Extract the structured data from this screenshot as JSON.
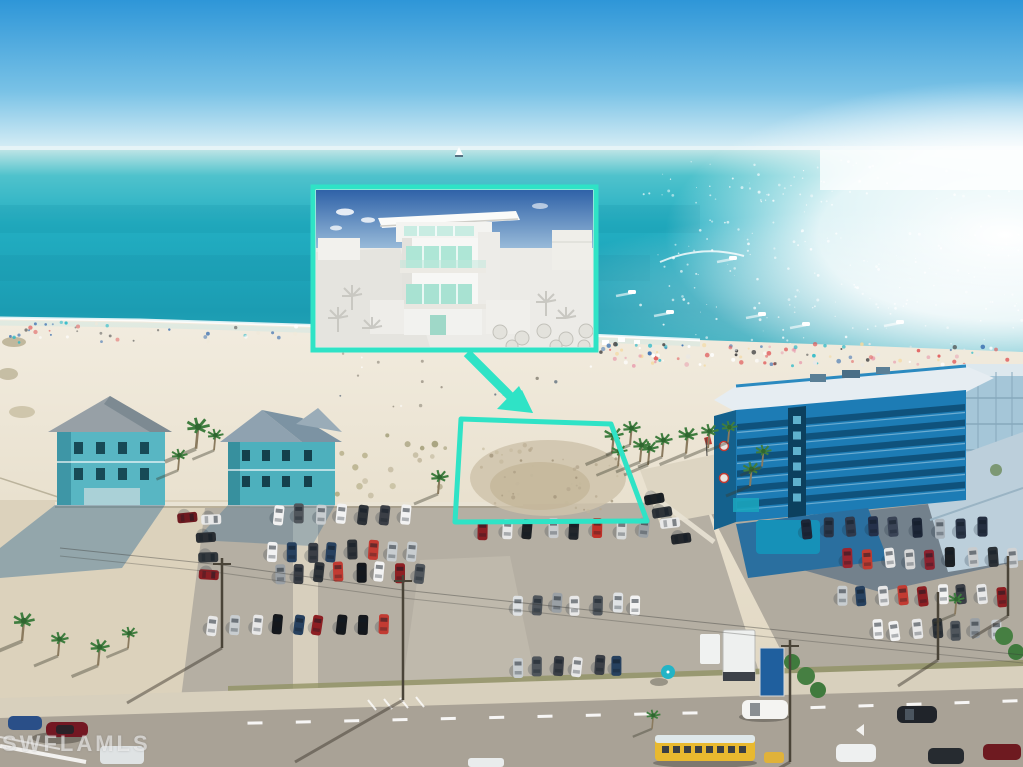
{
  "watermark": {
    "text": "SWFLAMLS"
  },
  "palette": {
    "accent_teal": "#2FE3C6",
    "sky_top": "#2E96D8",
    "sky_horizon": "#DCF0F6",
    "ocean_turquoise": "#27B4C6",
    "ocean_deep": "#1B9CB2",
    "sand_light": "#EFE9DB",
    "asphalt": "#B5AFA3",
    "road": "#A9A296",
    "hotel_blue": "#1D7CB5",
    "house_teal": "#55B6C2",
    "bus_yellow": "#E8B92F",
    "car_default": [
      "#f2f2f2",
      "#dfe2e4",
      "#15181c",
      "#2e3338",
      "#9aa0a5",
      "#8e1f23",
      "#c23b32",
      "#27415f",
      "#c8cdd0",
      "#3b3f46",
      "#e8e8e8",
      "#50565c"
    ]
  },
  "scene": {
    "boats": [
      {
        "x": 632,
        "y": 292
      },
      {
        "x": 670,
        "y": 312
      },
      {
        "x": 762,
        "y": 314
      },
      {
        "x": 806,
        "y": 324
      },
      {
        "x": 900,
        "y": 322
      },
      {
        "x": 733,
        "y": 258
      }
    ],
    "sailboat": {
      "x": 459,
      "y": 152
    },
    "hotel_floors": {
      "x0": 737,
      "y0l": 424,
      "x1": 965,
      "y0r": 404,
      "n": 6,
      "step": 15.5,
      "h": 6.5
    },
    "tower_windows": {
      "x": 793,
      "y0": 416,
      "n": 6,
      "step": 15.5,
      "w": 8,
      "h": 8
    },
    "dot_bands": [
      {
        "seed": 11,
        "x0": 598,
        "x1": 1020,
        "y0": 344,
        "y1": 366,
        "n": 115,
        "rmin": 1,
        "rmax": 2.4,
        "palette": [
          "#ffffff",
          "#e8e8e8",
          "#e05a5a",
          "#3a6fb0",
          "#28b8c8",
          "#e8a0b0",
          "#444444",
          "#f4d9a0"
        ],
        "op": 0.95
      },
      {
        "seed": 12,
        "x0": 10,
        "x1": 310,
        "y0": 322,
        "y1": 344,
        "n": 42,
        "rmin": 0.9,
        "rmax": 2.2,
        "palette": [
          "#ffffff",
          "#e05a5a",
          "#3a6fb0",
          "#28b8c8",
          "#555555",
          "#f0e8d8"
        ],
        "op": 0.9
      },
      {
        "seed": 13,
        "x0": 320,
        "x1": 600,
        "y0": 340,
        "y1": 412,
        "n": 26,
        "rmin": 0.8,
        "rmax": 1.8,
        "palette": [
          "#8a8274",
          "#6f685c",
          "#ffffff",
          "#5a6a7a"
        ],
        "op": 0.8
      },
      {
        "seed": 14,
        "x0": 940,
        "x1": 1020,
        "y0": 368,
        "y1": 395,
        "n": 18,
        "rmin": 1,
        "rmax": 2.2,
        "palette": [
          "#28b8c8",
          "#3a6fb0",
          "#ffffff",
          "#e05a5a"
        ],
        "op": 0.9
      },
      {
        "seed": 15,
        "x0": 480,
        "x1": 625,
        "y0": 445,
        "y1": 512,
        "n": 46,
        "rmin": 0.8,
        "rmax": 2.2,
        "palette": [
          "#b6a88e",
          "#a2947a",
          "#c4b89c"
        ],
        "op": 0.85
      },
      {
        "seed": 16,
        "x0": 335,
        "x1": 450,
        "y0": 435,
        "y1": 498,
        "n": 18,
        "rmin": 1.5,
        "rmax": 3.5,
        "palette": [
          "#a8a176",
          "#8f8a60",
          "#b5ab8d"
        ],
        "op": 0.8
      }
    ],
    "sparkles": {
      "seed": 21,
      "x0": 640,
      "x1": 1022,
      "y0": 158,
      "y1": 345,
      "n": 230,
      "rmin": 0.4,
      "rmax": 1.5,
      "palette": [
        "#ffffff"
      ],
      "op": 0.8
    },
    "car_rows": [
      {
        "seed": 31,
        "x0": 278,
        "y": 514,
        "dx": 21,
        "n": 7,
        "angle": 4
      },
      {
        "seed": 32,
        "x0": 483,
        "y": 529,
        "dx": 23,
        "n": 8,
        "angle": 3,
        "colors": [
          "#8a1f24",
          "#e8e8e8",
          "#1c2024",
          "#c9ccce",
          "#23272c",
          "#c03028",
          "#d8dad9",
          "#9aa0a4"
        ]
      },
      {
        "seed": 33,
        "x0": 272,
        "y": 551,
        "dx": 20,
        "n": 8,
        "angle": 2
      },
      {
        "seed": 34,
        "x0": 280,
        "y": 573,
        "dx": 20,
        "n": 8,
        "angle": 2
      },
      {
        "seed": 35,
        "x0": 214,
        "y": 626,
        "dx": 21,
        "n": 9,
        "angle": 5
      },
      {
        "seed": 36,
        "x0": 516,
        "y": 604,
        "dx": 20,
        "n": 7,
        "angle": 3
      },
      {
        "seed": 37,
        "x0": 518,
        "y": 666,
        "dx": 20,
        "n": 6,
        "angle": 3
      },
      {
        "seed": 38,
        "x0": 205,
        "y": 536,
        "dx": 2,
        "dy": 20,
        "n": 3,
        "angle": 90,
        "colors": [
          "#2a2e33",
          "#33383d",
          "#8a1f24"
        ]
      },
      {
        "seed": 39,
        "x0": 656,
        "y": 498,
        "dx": 8,
        "dy": 13,
        "n": 4,
        "angle": 80,
        "colors": [
          "#1c2024",
          "#2e3338",
          "#e8e8e8",
          "#23272c"
        ]
      },
      {
        "seed": 40,
        "x0": 806,
        "y": 528,
        "dx": 22,
        "n": 9,
        "angle": -2,
        "colors": [
          "#1d2738",
          "#2a3547",
          "#303a4c",
          "#24304a",
          "#3a4456",
          "#1d2738",
          "#aab4bc",
          "#2a3547",
          "#242e40"
        ]
      },
      {
        "seed": 41,
        "x0": 846,
        "y": 558,
        "dx": 21,
        "n": 9,
        "angle": -3,
        "colors": [
          "#9a2530",
          "#c13b30",
          "#e8e8e8",
          "#d8d8d8",
          "#8c2230",
          "#1d2125",
          "#c9ccce",
          "#2c3237",
          "#d0d3d5"
        ]
      },
      {
        "seed": 42,
        "x0": 842,
        "y": 596,
        "dx": 20,
        "n": 9,
        "angle": -3
      },
      {
        "seed": 43,
        "x0": 876,
        "y": 630,
        "dx": 20,
        "n": 7,
        "angle": -4
      },
      {
        "seed": 44,
        "x0": 186,
        "y": 519,
        "dx": 24,
        "n": 2,
        "angle": 88,
        "colors": [
          "#6e1a20",
          "#e8e8e8"
        ]
      }
    ],
    "road_dashes": [
      {
        "x0": 255,
        "y0": 723,
        "x1": 690,
        "y1": 713,
        "n": 10,
        "len": 15,
        "w": 3
      },
      {
        "x0": 770,
        "y0": 709,
        "x1": 1010,
        "y1": 701,
        "n": 6,
        "len": 15,
        "w": 3
      }
    ],
    "palms": [
      {
        "x": 196,
        "y": 428,
        "s": 1.3
      },
      {
        "x": 178,
        "y": 456,
        "s": 0.9
      },
      {
        "x": 214,
        "y": 436,
        "s": 0.9
      },
      {
        "x": 438,
        "y": 478,
        "s": 1.0
      },
      {
        "x": 612,
        "y": 436,
        "s": 1.1
      },
      {
        "x": 630,
        "y": 429,
        "s": 1.0
      },
      {
        "x": 648,
        "y": 449,
        "s": 1.0
      },
      {
        "x": 618,
        "y": 452,
        "s": 0.9
      },
      {
        "x": 640,
        "y": 446,
        "s": 1.0
      },
      {
        "x": 662,
        "y": 441,
        "s": 1.0
      },
      {
        "x": 686,
        "y": 436,
        "s": 1.1
      },
      {
        "x": 708,
        "y": 432,
        "s": 1.0
      },
      {
        "x": 728,
        "y": 428,
        "s": 0.9
      },
      {
        "x": 750,
        "y": 470,
        "s": 1.0
      },
      {
        "x": 762,
        "y": 452,
        "s": 0.9
      },
      {
        "x": 22,
        "y": 622,
        "s": 1.2
      },
      {
        "x": 58,
        "y": 640,
        "s": 1.0
      },
      {
        "x": 98,
        "y": 648,
        "s": 1.1
      },
      {
        "x": 128,
        "y": 634,
        "s": 0.9
      },
      {
        "x": 955,
        "y": 600,
        "s": 0.9
      },
      {
        "x": 652,
        "y": 716,
        "s": 0.8
      }
    ],
    "poles": [
      {
        "x": 403,
        "y0": 575,
        "y1": 700,
        "arm": 1,
        "shx": -108,
        "shy": 62
      },
      {
        "x": 222,
        "y0": 558,
        "y1": 648,
        "arm": 1,
        "shx": -95,
        "shy": 55
      },
      {
        "x": 790,
        "y0": 640,
        "y1": 762,
        "arm": 1,
        "shx": -70,
        "shy": 40
      },
      {
        "x": 938,
        "y0": 592,
        "y1": 660,
        "arm": 0,
        "shx": -40,
        "shy": 26
      },
      {
        "x": 1008,
        "y0": 556,
        "y1": 616,
        "arm": 0,
        "shx": -36,
        "shy": 22
      }
    ]
  }
}
